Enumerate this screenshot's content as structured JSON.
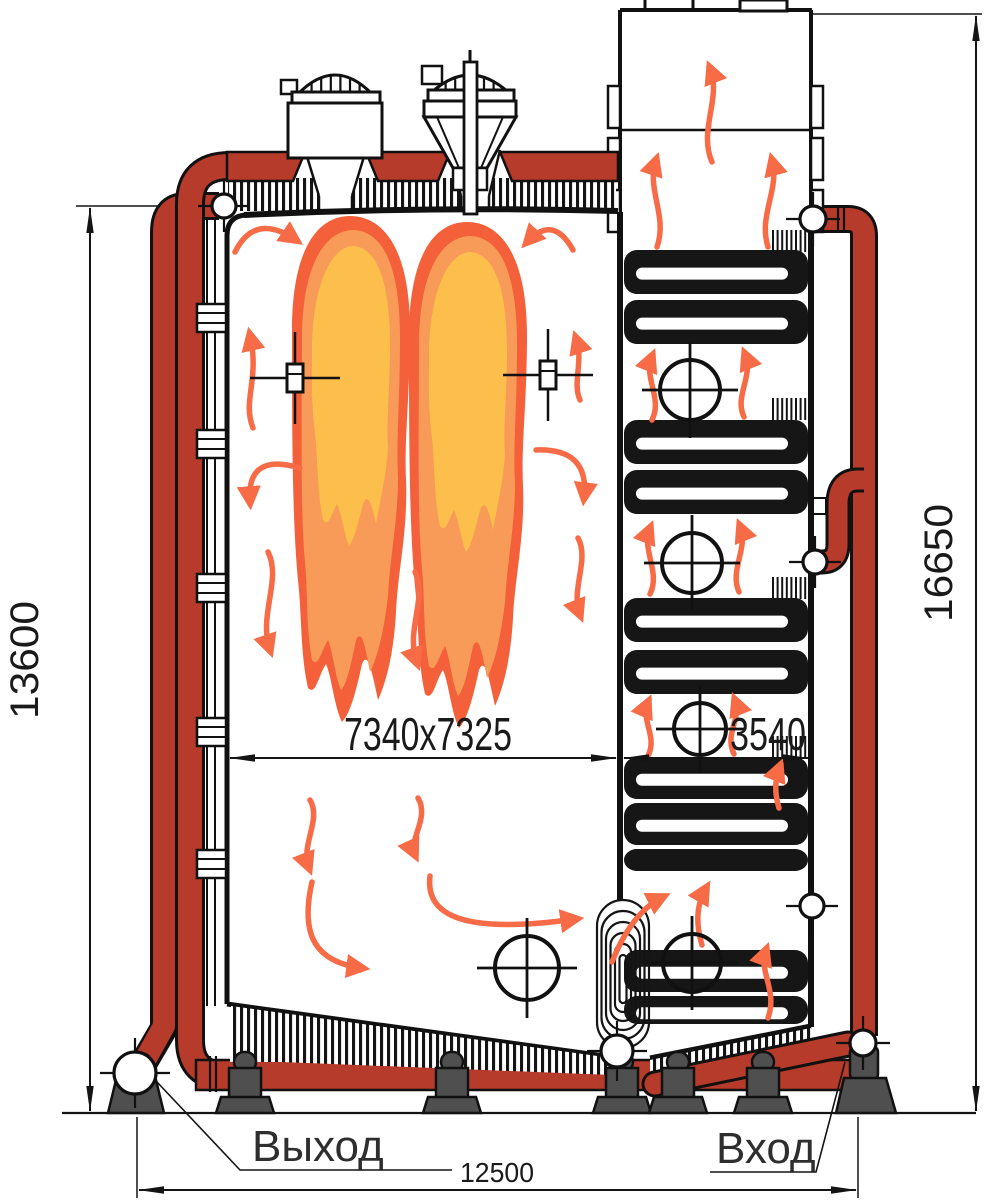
{
  "title": "Водотрубный котёл — продольный разрез",
  "labels": {
    "outlet": "Выход",
    "inlet": "Вход"
  },
  "dimensions": {
    "furnace_height": "13600",
    "overall_height": "16650",
    "furnace_width": "7340x7325",
    "convective_pass_width": "3540",
    "overall_width": "12500"
  },
  "colors": {
    "pipe-red": "#b63b2b",
    "flame-outer": "#f4603a",
    "flame-mid": "#f89b58",
    "flame-inner": "#fcbf4c",
    "arrow": "#f76b47",
    "foot-gray": "#4f4f4f"
  }
}
